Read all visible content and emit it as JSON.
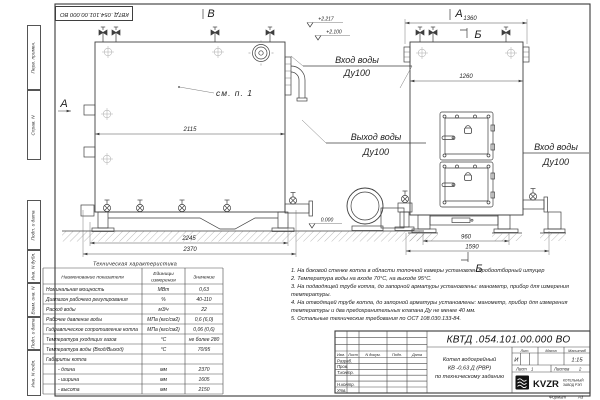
{
  "doc": {
    "number": "КВТД .054.101.00.000  ВО",
    "number_stamp": "КВТД .054.101.00.000  ВО",
    "format_label": "Формат",
    "format_value": "А3"
  },
  "margin": {
    "labels": [
      "Перв. примен.",
      "Справ. N",
      "Подп. и дата",
      "Инв. N дубл.",
      "Взам. инв. N",
      "Подп. и дата",
      "Инв. N подл."
    ]
  },
  "views": {
    "arrow_a_front": "А",
    "arrow_v_top": "В",
    "view_a_top": "А",
    "section_b_top": "Б",
    "section_b_bottom": "Б",
    "see_note": "см. п. 1"
  },
  "labels": {
    "inlet_top_1": "Вход воды",
    "inlet_top_2": "Ду100",
    "outlet_1": "Выход воды",
    "outlet_2": "Ду100",
    "inlet_side_1": "Вход воды",
    "inlet_side_2": "Ду100",
    "elev_high": "+2.217",
    "elev_mid": "+2.100",
    "elev_zero": "0.000"
  },
  "dims": {
    "front_top": "2115",
    "front_mid": "2245",
    "front_bottom": "2370",
    "side_top": "1360",
    "side_body": "1260",
    "side_feet": "960",
    "side_bottom": "1590"
  },
  "tech": {
    "title": "Техническая характеристика",
    "col_name": "Наименование показателя",
    "col_unit_1": "Единицы",
    "col_unit_2": "измерения",
    "col_value": "Значение",
    "rows": [
      {
        "name": "Номинальная мощность",
        "unit": "МВт",
        "value": "0,63"
      },
      {
        "name": "Диапазон рабочего регулирования",
        "unit": "%",
        "value": "40-110"
      },
      {
        "name": "Расход воды",
        "unit": "м3/ч",
        "value": "22"
      },
      {
        "name": "Рабочее давление воды",
        "unit": "МПа (кгс/см2)",
        "value": "0,6 (6,0)"
      },
      {
        "name": "Гидравлическое сопротивление котла",
        "unit": "МПа (кгс/см2)",
        "value": "0,06 (0,6)"
      },
      {
        "name": "Температура уходящих газов",
        "unit": "°С",
        "value": "не более 280"
      },
      {
        "name": "Температура воды (Вход/Выход)",
        "unit": "°С",
        "value": "70/95"
      },
      {
        "name": "Габариты котла",
        "unit": "",
        "value": ""
      },
      {
        "name": "- длина",
        "unit": "мм",
        "value": "2370"
      },
      {
        "name": "- ширина",
        "unit": "мм",
        "value": "1605"
      },
      {
        "name": "- высота",
        "unit": "мм",
        "value": "2150"
      }
    ]
  },
  "notes": {
    "items": [
      "1.  На боковой стенке котла в области топочной камеры установлен пробоотборный штуцер",
      "2.  Температура воды на входе 70°С, на выходе 95°С.",
      "3.  На подводящей трубе котла, до запорной арматуры установлены: манометр, прибор для измерения температуры.",
      "4.  На отводящей трубе котла, до запорной арматуры установлены: манометр, прибор для измерения температуры и два предохранительных клапана Ду не менее 40 мм.",
      "5.  Остальные технические требования по ОСТ 108.030.133-84."
    ]
  },
  "title_block": {
    "header_cells": [
      "Изм.",
      "Лист",
      "N докум.",
      "Подп.",
      "Дата"
    ],
    "row_labels": [
      "Разраб.",
      "Пров.",
      "Т.контр.",
      "",
      "Н.контр.",
      "Утв."
    ],
    "name_line1": "Котел водогрейный",
    "name_line2": "КВ -0,63  Д  (РВР)",
    "name_line3": "по техническому заданию",
    "lit_label": "Лит.",
    "lit_value": "И",
    "mass_label": "Масса",
    "scale_label": "Масштаб",
    "scale_value": "1:15",
    "sheet_label": "Лист",
    "sheet_value": "1",
    "sheets_label": "Листов",
    "sheets_value": "2",
    "logo_text": "KVZR",
    "logo_sub1": "КОТЕЛЬНЫЙ",
    "logo_sub2": "ЗАВОД РЭП"
  }
}
